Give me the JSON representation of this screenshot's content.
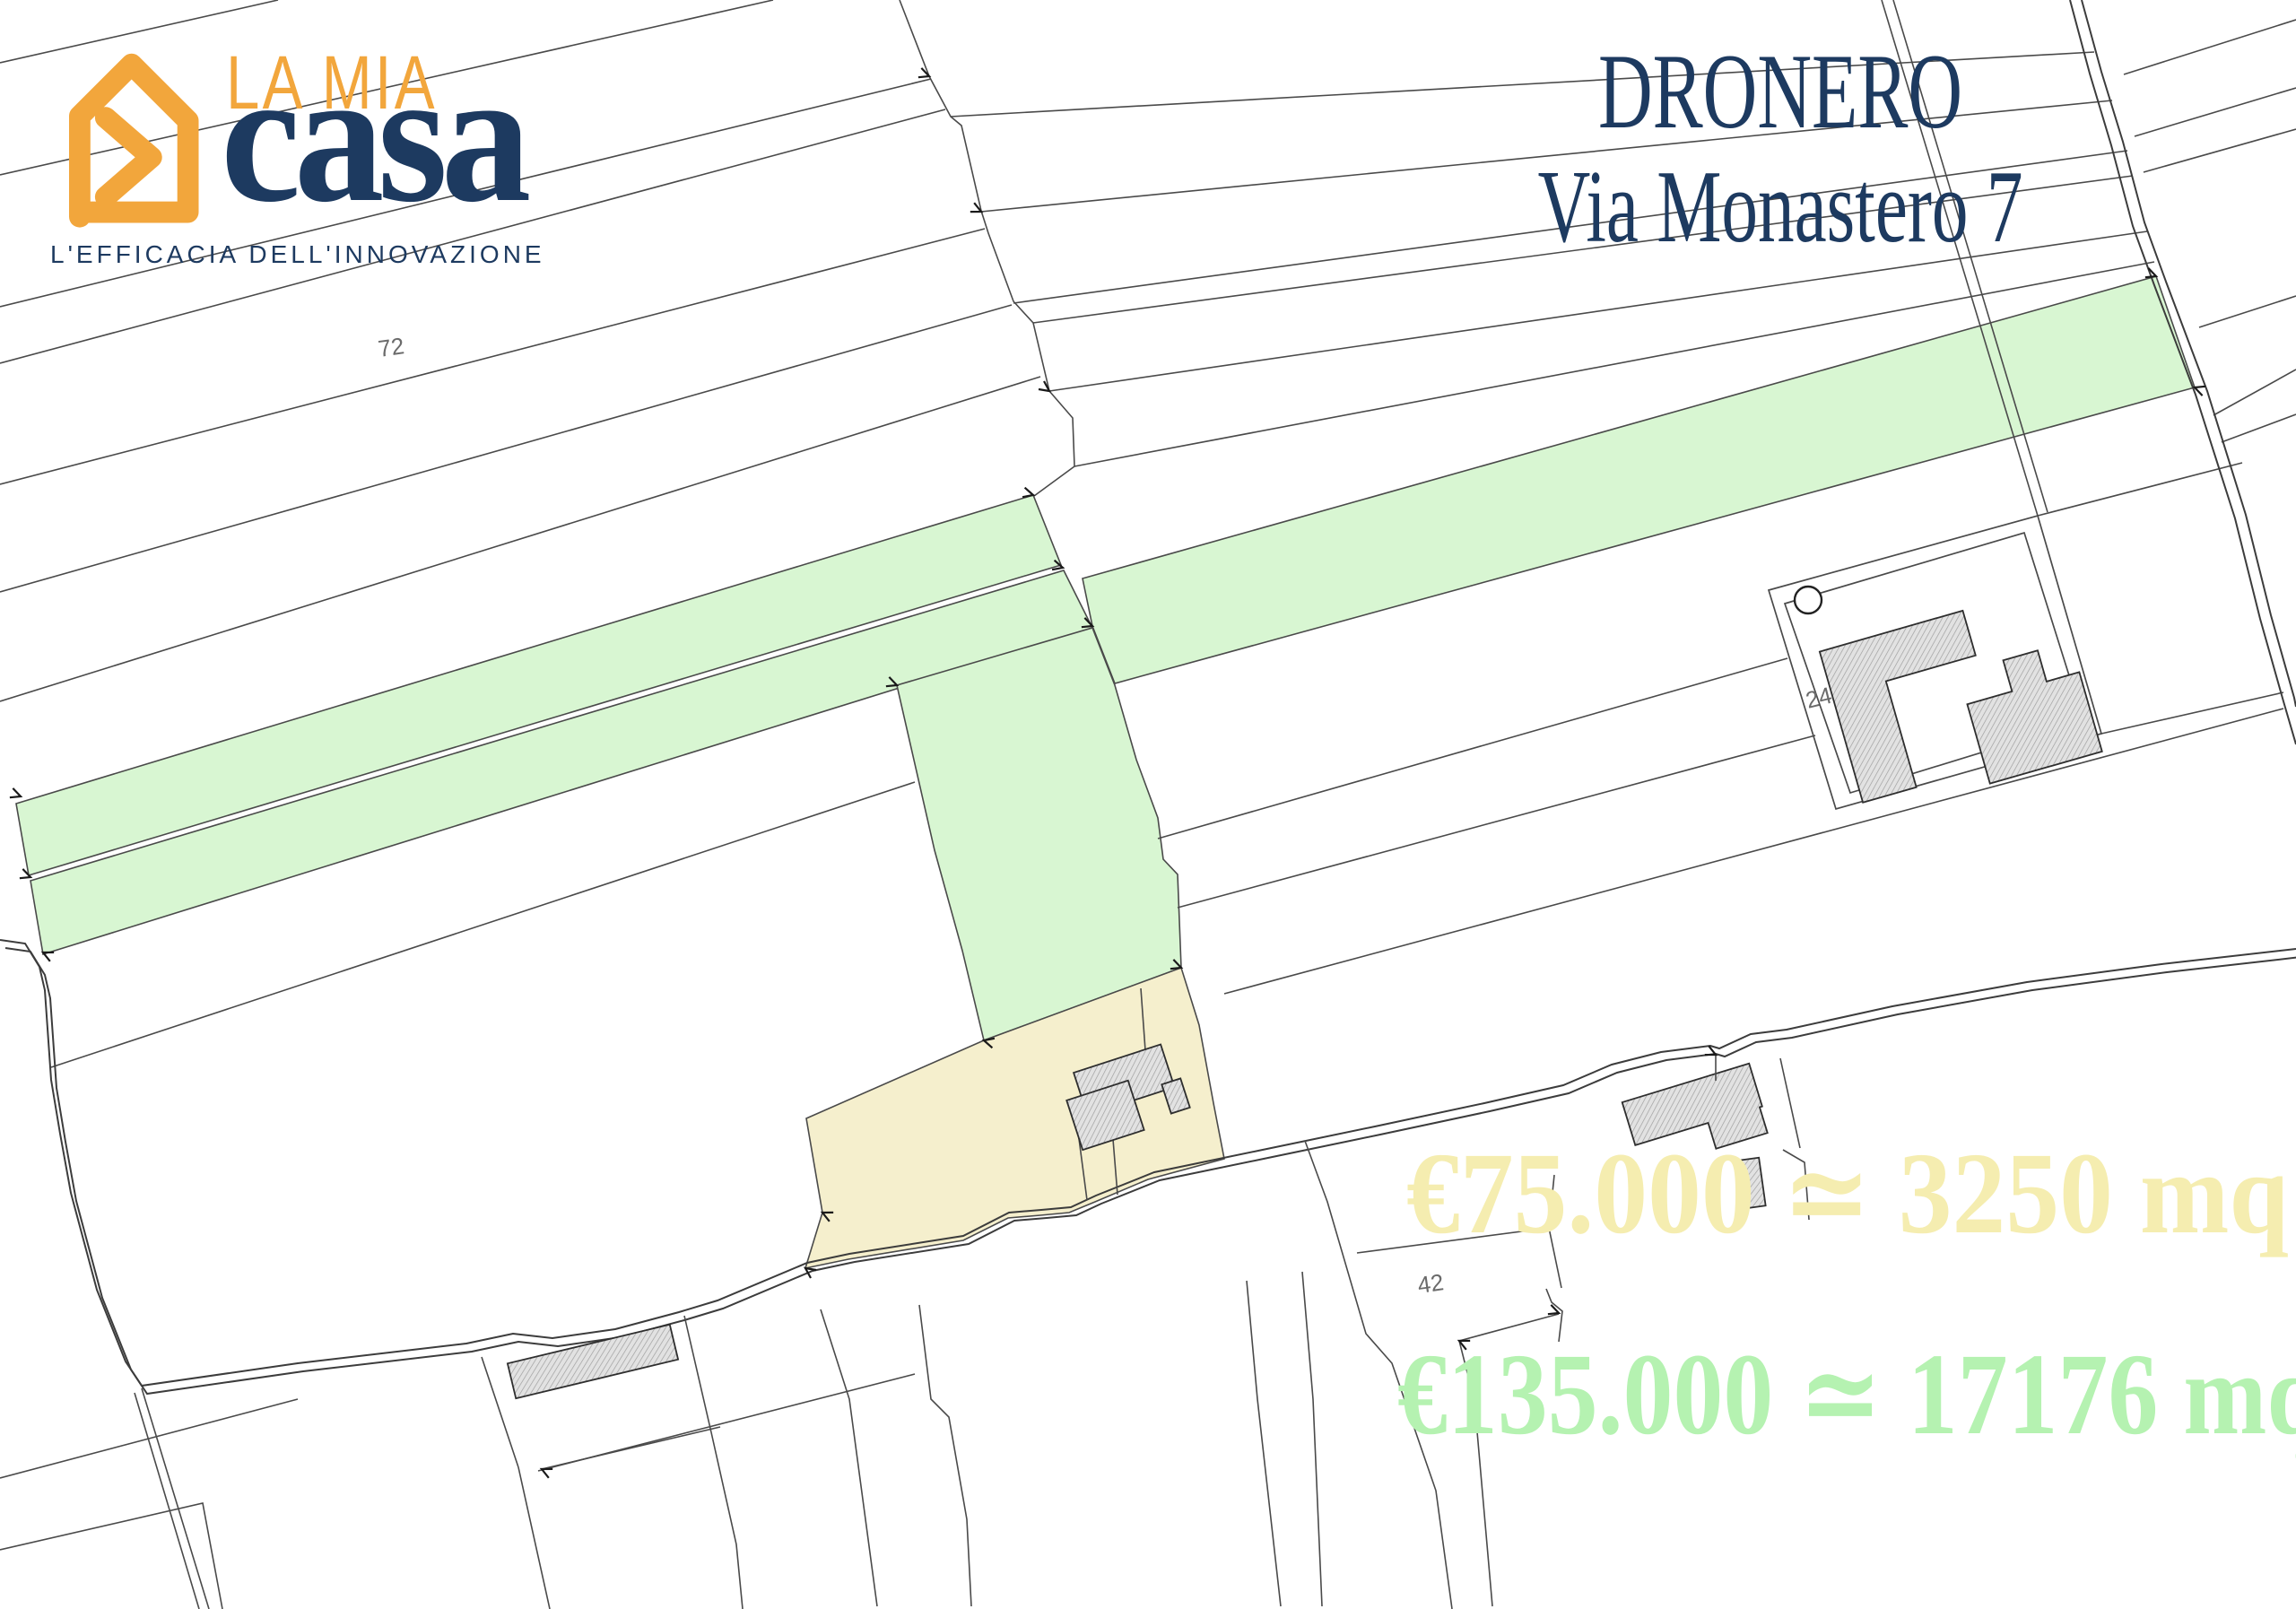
{
  "branding": {
    "brand_top": "LA MIA",
    "brand_main": "casa",
    "tagline": "L'EFFICACIA DELL'INNOVAZIONE",
    "orange": "#F2A63C",
    "navy": "#1D3A60"
  },
  "title": {
    "line1": "DRONERO",
    "line2": "Via Monastero 7",
    "color": "#1D3A60"
  },
  "offers": {
    "yellow_text": "€75.000 ≃ 3250 mq",
    "yellow_text_color": "#F5EDB0",
    "yellow_parcel_fill": "#F5EFCD",
    "green_text": "€135.000 ≃ 17176 mq",
    "green_text_color": "#B5F2B1",
    "green_parcel_fill": "#D8F6D2"
  },
  "map": {
    "labels": {
      "parcel72": "72",
      "parcel42": "42",
      "parcel24": "24"
    }
  }
}
